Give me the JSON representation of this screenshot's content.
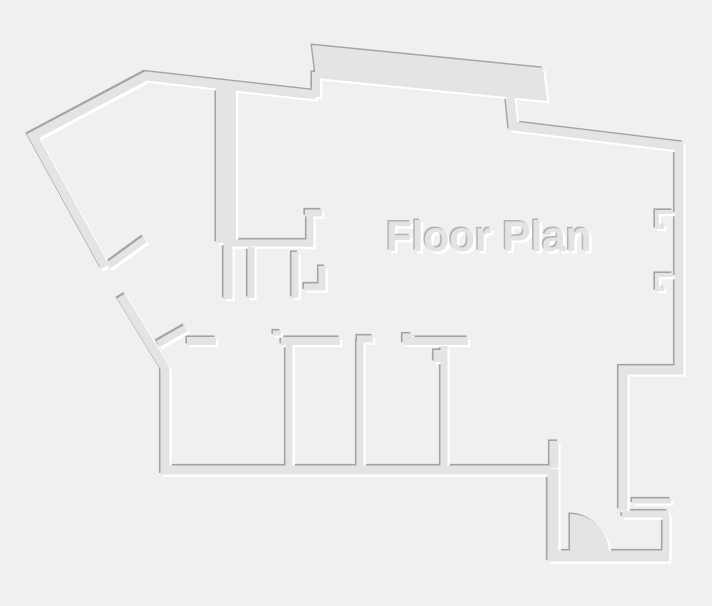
{
  "title": {
    "text": "Floor Plan"
  },
  "colors": {
    "background": "#f0f0f1",
    "wall_fill": "#e3e5e5",
    "edge_dark": "#a3a5a5",
    "edge_light": "#ffffff",
    "title_fill": "#e2e4e4",
    "title_shadow": "#b2b4b4"
  },
  "floor_plan": {
    "paths": {
      "outer_left": "M 316 95 L 146 76 L 33 136 L 105 267 M 121 296 L 165 368 L 165 470 L 551 470",
      "door_leaf_upper": "M 108 266 L 145 239",
      "door_leaf_lower": "M 158 344 L 186 328",
      "bay_band": "M 312 45 L 543 68 L 547 101 L 316 78 Z",
      "bay_connector": "M 316 72 L 316 97",
      "outer_right": "M 510 97 L 513 126 L 679 146 L 679 370 L 623 370 L 623 510",
      "window_notch_upper": "M 673 212 L 657 212 L 657 227 L 664 227",
      "window_notch_lower": "M 673 275 L 657 275 L 657 289 L 664 289",
      "entry_wall_h_upper": "M 632 501 L 671 501",
      "entry_wall_h_lower": "M 622 514 L 668 514",
      "entry_wall_v": "M 666 514 L 666 554",
      "entry_room": "M 553 469 L 553 556 L 669 556",
      "entry_stub": "M 554 441 L 554 468",
      "door_sector": "M 570 553 L 570 514 A 39 39 0 0 1 609 553 Z",
      "core_wall_thick": "M 226 87 L 226 243",
      "core_wall_thin": "M 228 243 L 228 299",
      "core_wall_h": "M 232 243 L 310 243",
      "core_corner_upper": "M 310 247 L 310 213 M 305 213 L 322 213",
      "core_stub_left": "M 251 247 L 251 298",
      "core_stub_right": "M 295 252 L 295 298",
      "core_corner_lower": "M 322 266 L 322 287 L 304 287",
      "rooms_top_wall": "M 187 341 L 216 341 M 281 341 L 340 341 M 405 341 L 468 341",
      "rooms_jamb_left": "M 273 333 L 281 333",
      "rooms_jamb_right": "M 405 344 L 405 336 L 412 336",
      "divider_1": "M 289 345 L 289 466",
      "divider_2": "M 360 341 L 360 466 M 357 339 L 373 339",
      "divider_3": "M 444 346 L 444 466 M 437 350 L 437 362"
    }
  }
}
